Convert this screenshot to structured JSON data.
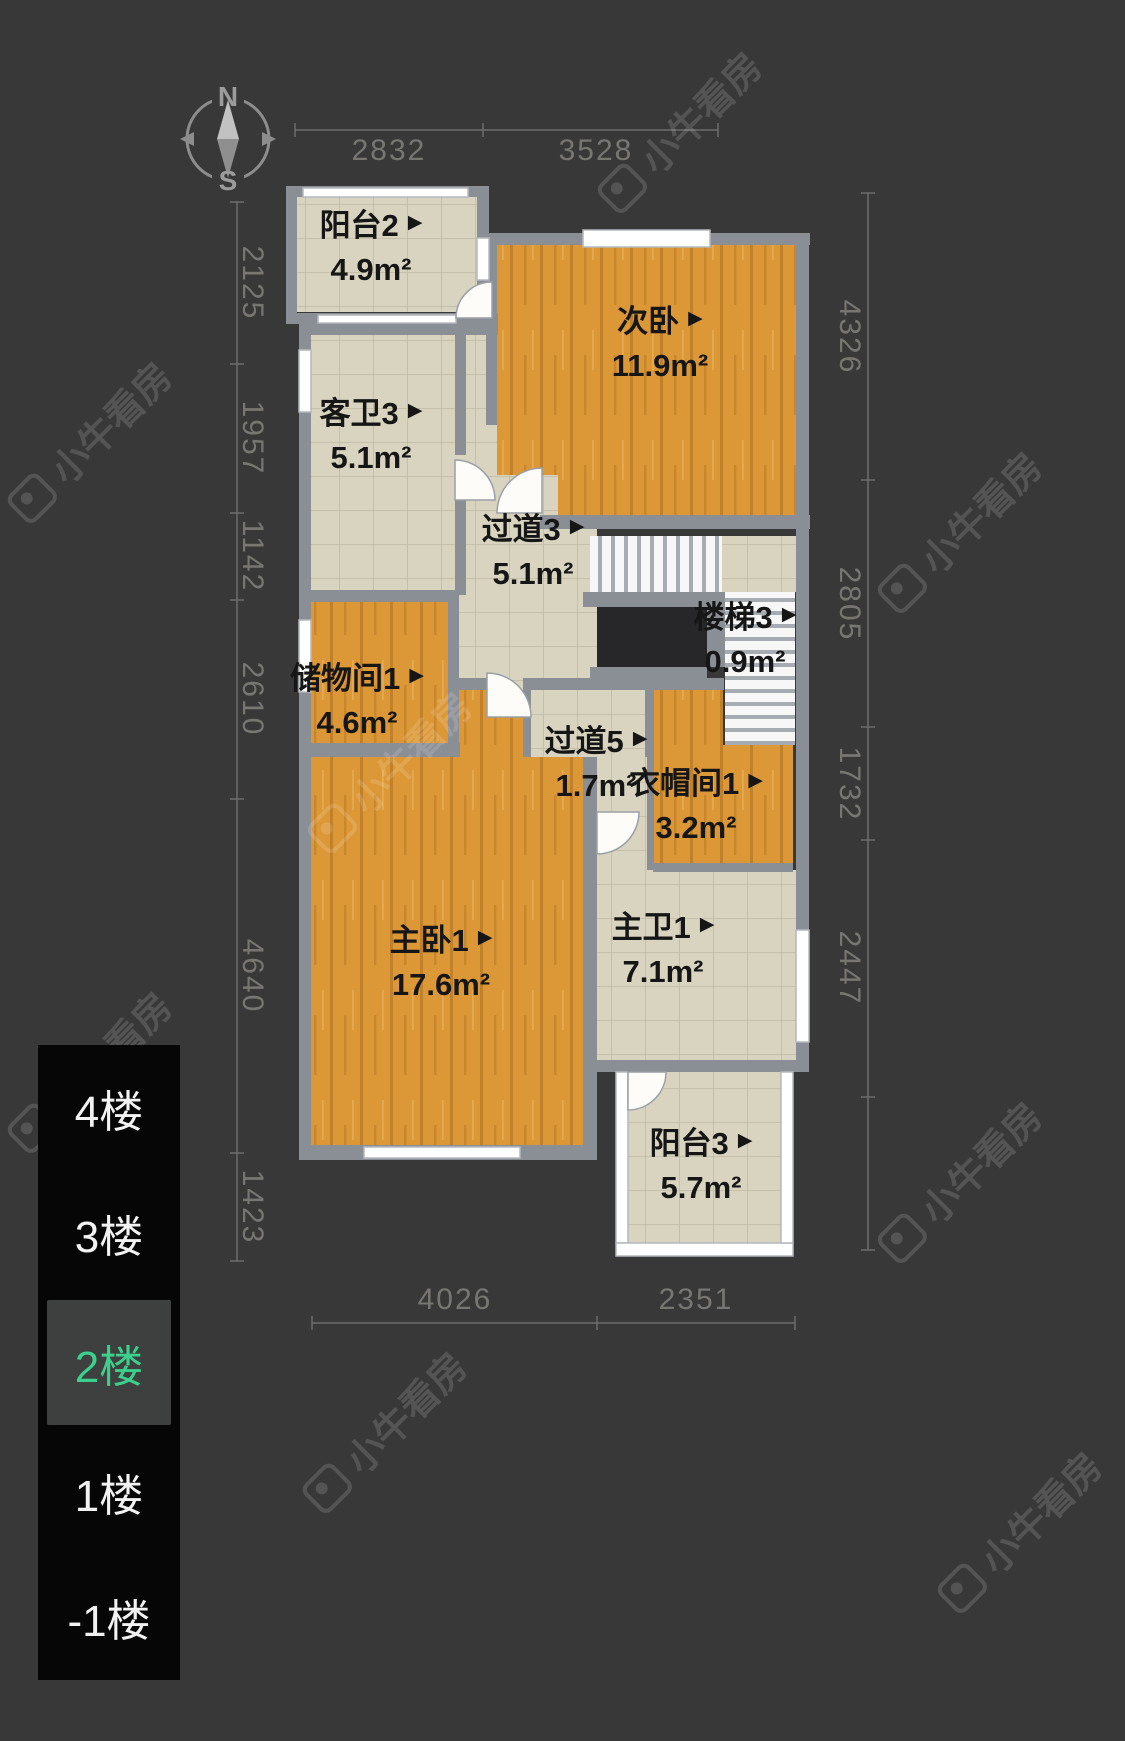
{
  "watermark": {
    "text": "小牛看房"
  },
  "compass": {
    "north": "N",
    "south": "S"
  },
  "marker": "▶",
  "rooms": [
    {
      "id": "balcony2",
      "name": "阳台2",
      "area": "4.9m²"
    },
    {
      "id": "bedroom2",
      "name": "次卧",
      "area": "11.9m²"
    },
    {
      "id": "bath3",
      "name": "客卫3",
      "area": "5.1m²"
    },
    {
      "id": "corridor3",
      "name": "过道3",
      "area": "5.1m²"
    },
    {
      "id": "stairs3",
      "name": "楼梯3",
      "area": "0.9m²"
    },
    {
      "id": "storage1",
      "name": "储物间1",
      "area": "4.6m²"
    },
    {
      "id": "corridor5",
      "name": "过道5",
      "area": "1.7m²"
    },
    {
      "id": "wardrobe1",
      "name": "衣帽间1",
      "area": "3.2m²"
    },
    {
      "id": "master1",
      "name": "主卧1",
      "area": "17.6m²"
    },
    {
      "id": "masterbath1",
      "name": "主卫1",
      "area": "7.1m²"
    },
    {
      "id": "balcony3",
      "name": "阳台3",
      "area": "5.7m²"
    }
  ],
  "dimensions": {
    "top": [
      "2832",
      "3528"
    ],
    "bottom": [
      "4026",
      "2351"
    ],
    "left": [
      "2125",
      "1957",
      "1142",
      "2610",
      "4640",
      "1423"
    ],
    "right": [
      "4326",
      "2805",
      "1732",
      "2447"
    ]
  },
  "floor_selector": {
    "selected": "2楼",
    "floors": [
      {
        "label": "4楼",
        "selected": false
      },
      {
        "label": "3楼",
        "selected": false
      },
      {
        "label": "2楼",
        "selected": true
      },
      {
        "label": "1楼",
        "selected": false
      },
      {
        "label": "-1楼",
        "selected": false
      }
    ]
  },
  "colors": {
    "background": "#383838",
    "wall": "#8a8e95",
    "wood_floor": "#dc9836",
    "tile_floor": "#d9d4c0",
    "accent_green": "#3bd08c",
    "selector_bg": "#060606",
    "dim_text": "#777672"
  }
}
